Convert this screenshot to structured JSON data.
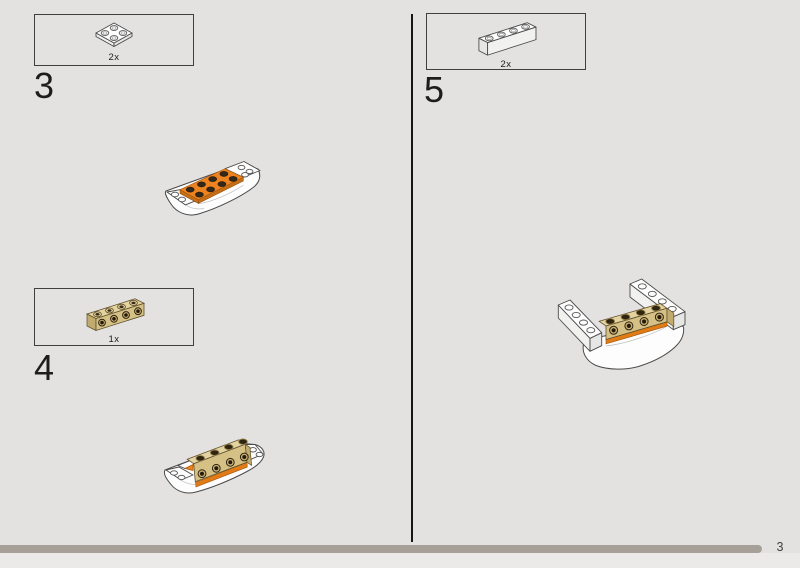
{
  "page": {
    "background": "#e3e2e1",
    "page_number": "3"
  },
  "progress": {
    "bar_color": "#a7a099"
  },
  "steps": {
    "step3": {
      "number": "3",
      "part_count": "2x",
      "part_name": "white-2x2-plate"
    },
    "step4": {
      "number": "4",
      "part_count": "1x",
      "part_name": "tan-1x4-brick-with-side-studs"
    },
    "step5": {
      "number": "5",
      "part_count": "2x",
      "part_name": "white-1x4-brick"
    }
  },
  "colors": {
    "orange": "#ec8220",
    "orange_dark": "#c76f14",
    "tan_top": "#e3d3a1",
    "tan_front": "#d5c186",
    "tan_side": "#c2ab6e",
    "stud_dark": "#2e2412",
    "outline": "#4a4a4a",
    "bar": "#a7a099"
  }
}
